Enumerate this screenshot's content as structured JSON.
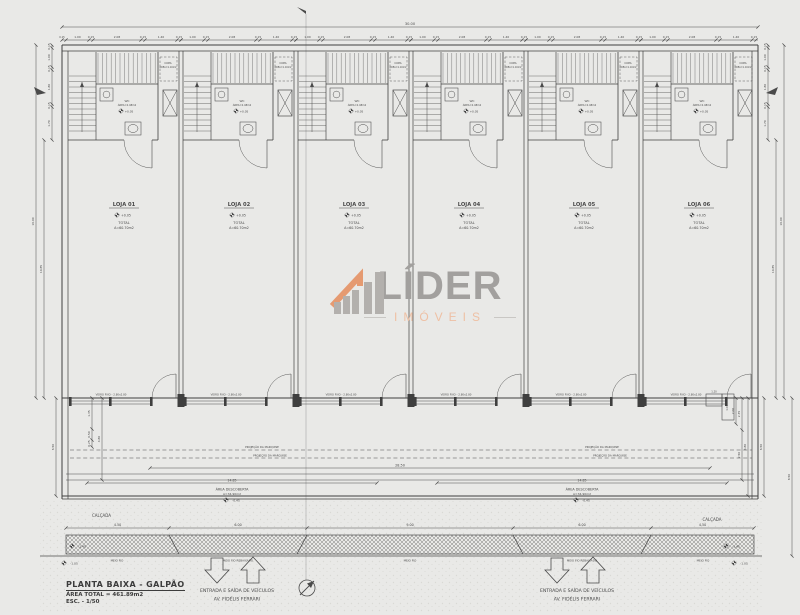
{
  "colors": {
    "paper": "#e9e9e7",
    "ink": "#4a4a4a",
    "wall": "#3f3f3f",
    "logo_gray": "#a2a09e",
    "logo_orange": "#e59a71",
    "logo_orange_light": "#eec0a4"
  },
  "logo": {
    "name": "LÍDER",
    "subtitle": "IMÓVEIS"
  },
  "title_block": {
    "title": "PLANTA BAIXA - GALPÃO",
    "area": "ÁREA TOTAL = 461.89m2",
    "scale": "ESC. - 1/50"
  },
  "entrance": {
    "line1": "ENTRADA  E  SAÍDA  DE  VEÍCULOS",
    "line2": "AV.  FIDÉLIS  FERRARI"
  },
  "unit_common": {
    "wc": "WC",
    "wc_area": "ÁREA=2.48m2",
    "wc_level": "+0.05",
    "copa": "COPA",
    "copa_area": "ÁREA=1.10m2",
    "total": "TOTAL",
    "window": "VIDRO FIXO - 2.80x2.80"
  },
  "units": [
    {
      "name": "LOJA 01",
      "level": "+0.05",
      "area": "A=60.70m2"
    },
    {
      "name": "LOJA 02",
      "level": "+0.05",
      "area": "A=60.70m2"
    },
    {
      "name": "LOJA 03",
      "level": "+0.05",
      "area": "A=60.70m2"
    },
    {
      "name": "LOJA 04",
      "level": "+0.05",
      "area": "A=60.70m2"
    },
    {
      "name": "LOJA 05",
      "level": "+0.05",
      "area": "A=60.70m2"
    },
    {
      "name": "LOJA 06",
      "level": "+0.05",
      "area": "A=60.70m2"
    }
  ],
  "dims": {
    "overall_width": "30.00",
    "top_lead": "0.15",
    "top_chain": [
      "1.00",
      "0.15",
      "2.08",
      "0.15",
      "1.40",
      "0.15"
    ],
    "side_chain": [
      "0.15",
      "1.00",
      "0.15",
      "1.80",
      "0.15",
      "1.70"
    ],
    "side_hall": "10.85",
    "side_total": "16.00",
    "yard_width": "28.50",
    "yard_half": "14.85",
    "sidewalk": [
      "4.50",
      "6.00",
      "9.00",
      "6.00",
      "4.50"
    ],
    "left_lower": [
      "1.35",
      "0.50",
      "0.25",
      "4.80",
      "6.50"
    ],
    "right_lower": [
      "1.20",
      "1.00",
      "2.00",
      "2.35",
      "2.50",
      "4.80",
      "6.50",
      "8.50"
    ]
  },
  "annotations": {
    "marquise": "PROJEÇÃO DA MARQUISE",
    "area_descoberta_1": "ÁREA DESCOBERTA",
    "area_descoberta_2": "A=34.90m2",
    "area_descoberta_level": "-0.45",
    "calcada": "CALÇADA",
    "meio_fio": "MEIO FIO",
    "meio_fio_rebaixado": "MEIO FIO REBAIXADO",
    "curb_level_1": "-1.45",
    "curb_level_2": "-1.05"
  }
}
